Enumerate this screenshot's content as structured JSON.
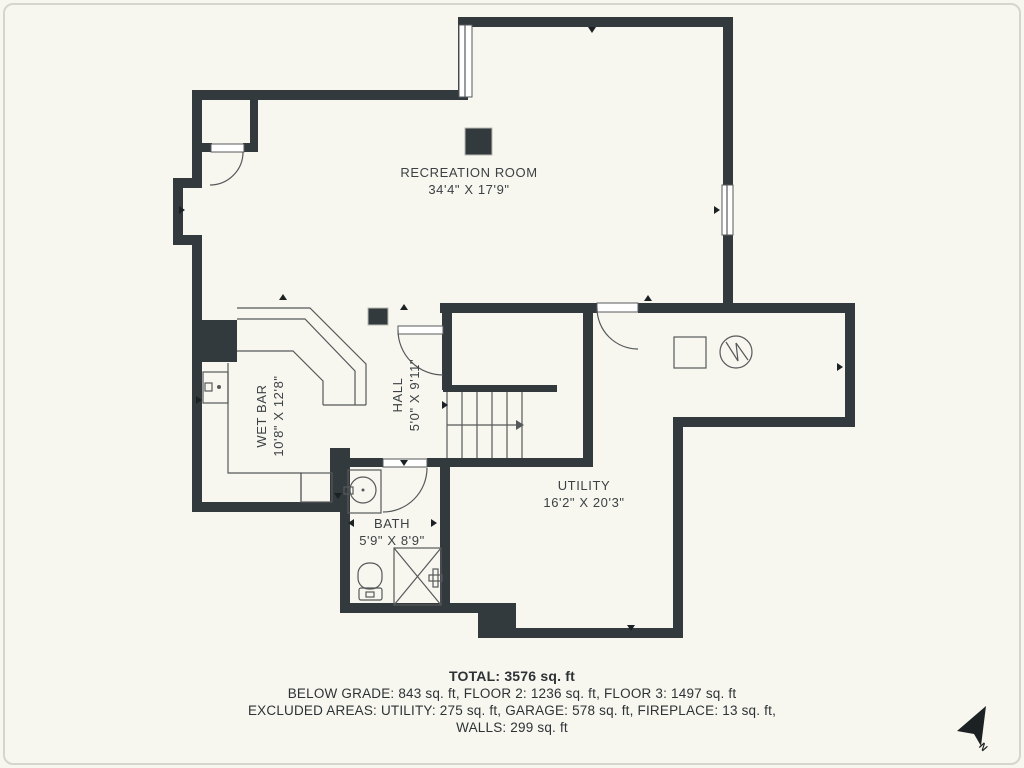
{
  "colors": {
    "background": "#f8f7ef",
    "wall": "#333a3d",
    "thin_line": "#56595b",
    "label_text": "#3b4145",
    "summary_text": "#2c3236",
    "fixture_fill": "#ffffff"
  },
  "rooms": [
    {
      "name": "RECREATION ROOM",
      "dims": "34'4\" X 17'9\"",
      "cx": 469,
      "cy": 181,
      "rotated": false
    },
    {
      "name": "WET BAR",
      "dims": "10'8\" X 12'8\"",
      "cx": 270,
      "cy": 416,
      "rotated": true
    },
    {
      "name": "HALL",
      "dims": "5'0\" X 9'11\"",
      "cx": 406,
      "cy": 395,
      "rotated": true
    },
    {
      "name": "BATH",
      "dims": "5'9\" X 8'9\"",
      "cx": 392,
      "cy": 532,
      "rotated": false
    },
    {
      "name": "UTILITY",
      "dims": "16'2\" X 20'3\"",
      "cx": 584,
      "cy": 494,
      "rotated": false
    }
  ],
  "summary": {
    "total": "TOTAL: 3576 sq. ft",
    "line2": "BELOW GRADE: 843 sq. ft, FLOOR 2: 1236 sq. ft, FLOOR 3: 1497 sq. ft",
    "line3": "EXCLUDED AREAS: UTILITY: 275 sq. ft, GARAGE: 578 sq. ft, FIREPLACE: 13 sq. ft,",
    "line4": "WALLS: 299 sq. ft"
  },
  "compass": {
    "label": "N",
    "arrow": "986,706 957,731 974,734 981,746"
  },
  "plan": {
    "walls": [
      [
        458,
        17,
        275,
        10
      ],
      [
        458,
        17,
        10,
        83
      ],
      [
        723,
        17,
        10,
        296
      ],
      [
        192,
        90,
        276,
        10
      ],
      [
        192,
        90,
        10,
        88
      ],
      [
        250,
        100,
        8,
        52
      ],
      [
        192,
        143,
        20,
        9
      ],
      [
        243,
        143,
        15,
        9
      ],
      [
        173,
        178,
        29,
        10
      ],
      [
        173,
        178,
        10,
        67
      ],
      [
        173,
        235,
        29,
        10
      ],
      [
        192,
        245,
        10,
        75
      ],
      [
        192,
        320,
        45,
        42
      ],
      [
        192,
        362,
        10,
        150
      ],
      [
        192,
        502,
        141,
        10
      ],
      [
        330,
        448,
        20,
        64
      ],
      [
        340,
        512,
        10,
        91
      ],
      [
        340,
        603,
        150,
        10
      ],
      [
        478,
        603,
        38,
        35
      ],
      [
        506,
        628,
        177,
        10
      ],
      [
        673,
        417,
        10,
        221
      ],
      [
        673,
        417,
        182,
        10
      ],
      [
        845,
        303,
        10,
        124
      ],
      [
        440,
        303,
        157,
        10
      ],
      [
        638,
        303,
        217,
        10
      ],
      [
        442,
        303,
        10,
        87
      ],
      [
        443,
        385,
        114,
        7
      ],
      [
        583,
        303,
        10,
        164
      ],
      [
        348,
        458,
        35,
        9
      ],
      [
        427,
        458,
        166,
        9
      ],
      [
        440,
        458,
        10,
        155
      ]
    ],
    "columns": [
      [
        465,
        128,
        27,
        27
      ],
      [
        368,
        308,
        20,
        17
      ]
    ],
    "shapes": [
      {
        "t": "path",
        "d": "M237 308 L310 308 L366 364 L366 405"
      },
      {
        "t": "path",
        "d": "M237 319 L305 319 L355 371 L355 405"
      },
      {
        "t": "path",
        "d": "M237 351 L293 351 L323 381 L323 405"
      },
      {
        "t": "line",
        "p": [
          323,
          405,
          366,
          405
        ]
      },
      {
        "t": "path",
        "d": "M228 363 L228 473 L301 473 L301 502"
      },
      {
        "t": "rect",
        "p": [
          301,
          473,
          31,
          29
        ]
      },
      {
        "t": "rect",
        "p": [
          203,
          372,
          25,
          31
        ]
      },
      {
        "t": "rect",
        "p": [
          205,
          383,
          7,
          8
        ]
      },
      {
        "t": "dot",
        "p": [
          219,
          387,
          2
        ]
      },
      {
        "t": "rect",
        "p": [
          348,
          470,
          33,
          43
        ]
      },
      {
        "t": "circle",
        "p": [
          363,
          490,
          13
        ]
      },
      {
        "t": "rect",
        "p": [
          344,
          487,
          9,
          7
        ]
      },
      {
        "t": "dot",
        "p": [
          363,
          490,
          1.5
        ]
      },
      {
        "t": "rect",
        "p": [
          358,
          563,
          24,
          26
        ],
        "rx": 11
      },
      {
        "t": "rect",
        "p": [
          359,
          588,
          23,
          12
        ],
        "rx": 2
      },
      {
        "t": "rect",
        "p": [
          366,
          592,
          8,
          5
        ]
      },
      {
        "t": "rect",
        "p": [
          394,
          548,
          47,
          57
        ]
      },
      {
        "t": "line",
        "p": [
          394,
          548,
          441,
          605
        ]
      },
      {
        "t": "line",
        "p": [
          441,
          548,
          394,
          605
        ]
      },
      {
        "t": "rect",
        "p": [
          433,
          569,
          5,
          18
        ]
      },
      {
        "t": "rect",
        "p": [
          429,
          575,
          13,
          6
        ]
      },
      {
        "t": "rect",
        "p": [
          674,
          337,
          32,
          31
        ]
      },
      {
        "t": "circle",
        "p": [
          736,
          352,
          16
        ]
      },
      {
        "t": "path",
        "d": "M726 342 L738 361 L736 343 L748 360"
      },
      {
        "t": "line",
        "p": [
          447,
          392,
          447,
          458
        ]
      },
      {
        "t": "line",
        "p": [
          462,
          392,
          462,
          458
        ]
      },
      {
        "t": "line",
        "p": [
          477,
          392,
          477,
          458
        ]
      },
      {
        "t": "line",
        "p": [
          492,
          392,
          492,
          458
        ]
      },
      {
        "t": "line",
        "p": [
          507,
          392,
          507,
          458
        ]
      },
      {
        "t": "line",
        "p": [
          522,
          392,
          522,
          458
        ]
      },
      {
        "t": "line",
        "p": [
          447,
          425,
          516,
          425
        ]
      },
      {
        "t": "tri",
        "p": [
          516,
          420,
          524,
          425,
          516,
          430
        ]
      },
      {
        "t": "wrect",
        "p": [
          459,
          25,
          13,
          72
        ]
      },
      {
        "t": "line",
        "p": [
          465,
          25,
          465,
          97
        ]
      },
      {
        "t": "wrect",
        "p": [
          722,
          185,
          11,
          50
        ]
      },
      {
        "t": "line",
        "p": [
          727,
          185,
          727,
          235
        ]
      },
      {
        "t": "wrect",
        "p": [
          211,
          144,
          33,
          8
        ]
      },
      {
        "t": "path",
        "d": "M243 152 A33 33 0 0 1 210 185"
      },
      {
        "t": "wrect",
        "p": [
          398,
          326,
          45,
          8
        ]
      },
      {
        "t": "path",
        "d": "M398 330 A45 45 0 0 0 443 375"
      },
      {
        "t": "wrect",
        "p": [
          383,
          459,
          44,
          8
        ]
      },
      {
        "t": "path",
        "d": "M427 468 A44 44 0 0 1 383 512"
      },
      {
        "t": "wrect",
        "p": [
          597,
          303,
          41,
          9
        ]
      },
      {
        "t": "path",
        "d": "M597 308 A41 41 0 0 0 638 349"
      }
    ],
    "markers": [
      [
        283,
        297,
        "up"
      ],
      [
        592,
        30,
        "down"
      ],
      [
        182,
        210,
        "right"
      ],
      [
        717,
        210,
        "right"
      ],
      [
        351,
        523,
        "left"
      ],
      [
        434,
        523,
        "right"
      ],
      [
        840,
        367,
        "right"
      ],
      [
        631,
        628,
        "down"
      ],
      [
        404,
        307,
        "up"
      ],
      [
        199,
        400,
        "right"
      ],
      [
        648,
        298,
        "up"
      ],
      [
        404,
        463,
        "down"
      ],
      [
        338,
        496,
        "down"
      ],
      [
        445,
        405,
        "right"
      ]
    ]
  }
}
